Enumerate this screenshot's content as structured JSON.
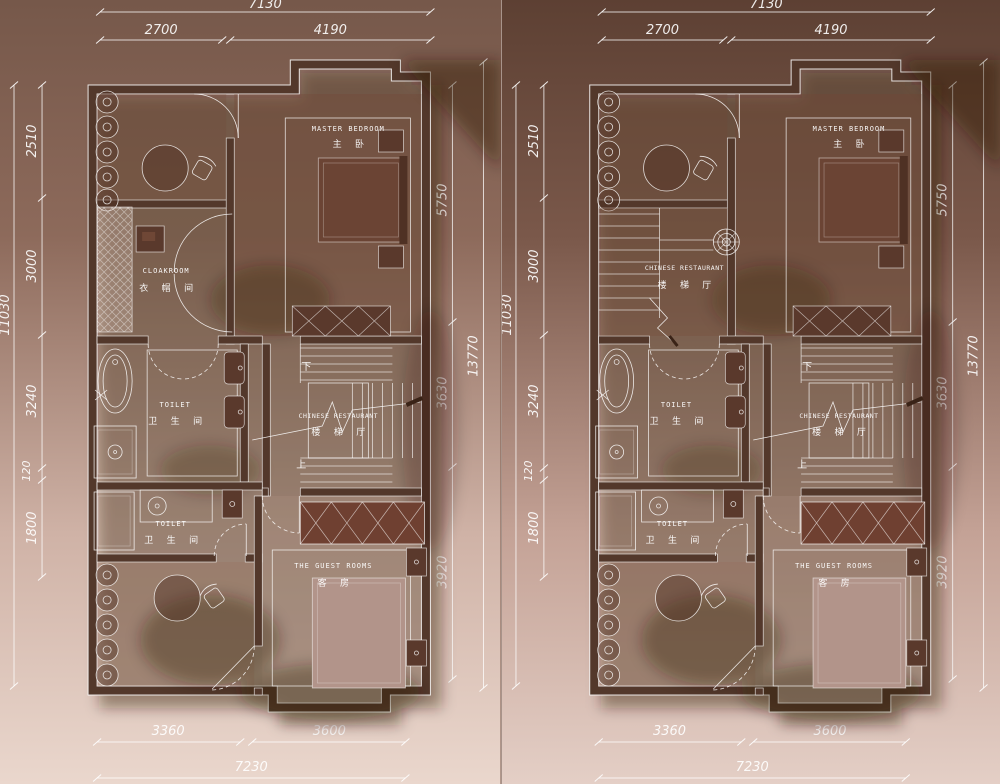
{
  "colors": {
    "panel_a_top": "#76584a",
    "panel_a_mid": "#8d6a5b",
    "panel_a_low": "#cfb2a6",
    "panel_a_bottom": "#ead7cd",
    "panel_b_top": "#5d4033",
    "panel_b_mid": "#7a584a",
    "panel_b_low": "#c4a296",
    "panel_b_bottom": "#e4cfc6",
    "wall": "#53382b",
    "line": "#ffffff",
    "master_bed": "#6b4434",
    "wardrobe": "#6f4031"
  },
  "dimensions": {
    "top": {
      "overall": "7130",
      "segments": [
        "2700",
        "4190"
      ]
    },
    "left": {
      "overall": "11030",
      "segments": [
        "2510",
        "3000",
        "3240",
        "120",
        "1800"
      ]
    },
    "right": {
      "overall": "13770",
      "segments": [
        "5750",
        "3630",
        "3920"
      ]
    },
    "bottom": {
      "overall": "7230",
      "segments": [
        "3360",
        "3600"
      ]
    }
  },
  "rooms": {
    "master_bedroom": {
      "en": "MASTER BEDROOM",
      "cn": "主 卧"
    },
    "cloakroom": {
      "en": "CLOAKROOM",
      "cn": "衣 帽 间"
    },
    "toilet_main": {
      "en": "TOILET",
      "cn": "卫 生 间"
    },
    "toilet_small": {
      "en": "TOILET",
      "cn": "卫 生 间"
    },
    "stair_hall_center": {
      "en": "CHINESE RESTAURANT",
      "cn": "楼 梯 厅"
    },
    "stair_hall_upper": {
      "en": "CHINESE RESTAURANT",
      "cn": "楼 梯 厅"
    },
    "guest_rooms": {
      "en": "THE GUEST ROOMS",
      "cn": "客 房"
    }
  },
  "stairs": {
    "down": "下",
    "up": "上"
  }
}
